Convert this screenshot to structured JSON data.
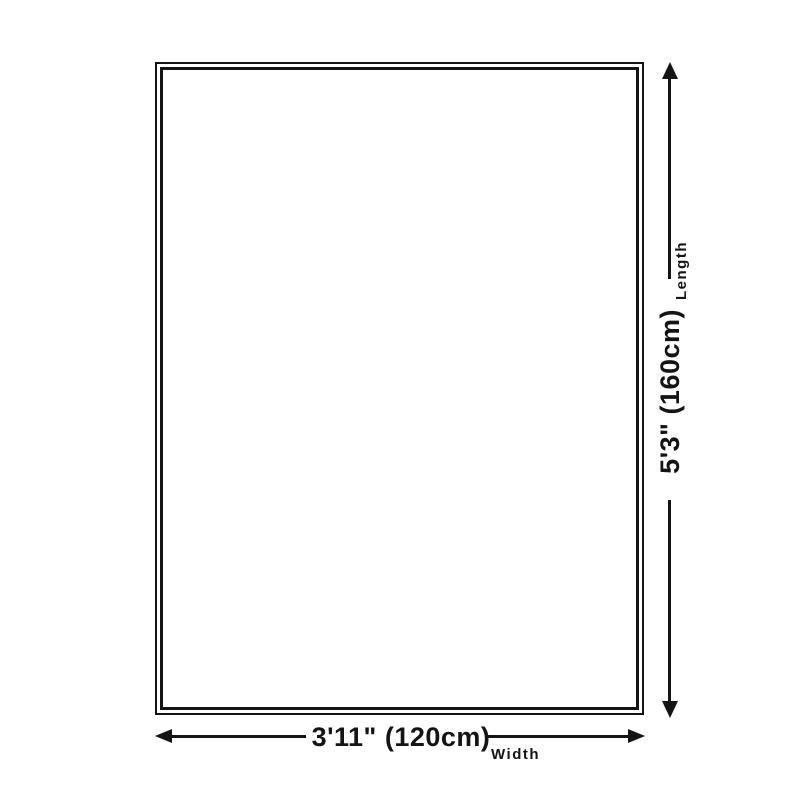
{
  "diagram": {
    "kind": "product-size-diagram",
    "length": {
      "value": "5'3\" (160cm)",
      "label": "Length"
    },
    "width": {
      "value": "3'11\" (120cm)",
      "label": "Width"
    },
    "colors": {
      "line": "#141414",
      "background": "#ffffff"
    }
  }
}
